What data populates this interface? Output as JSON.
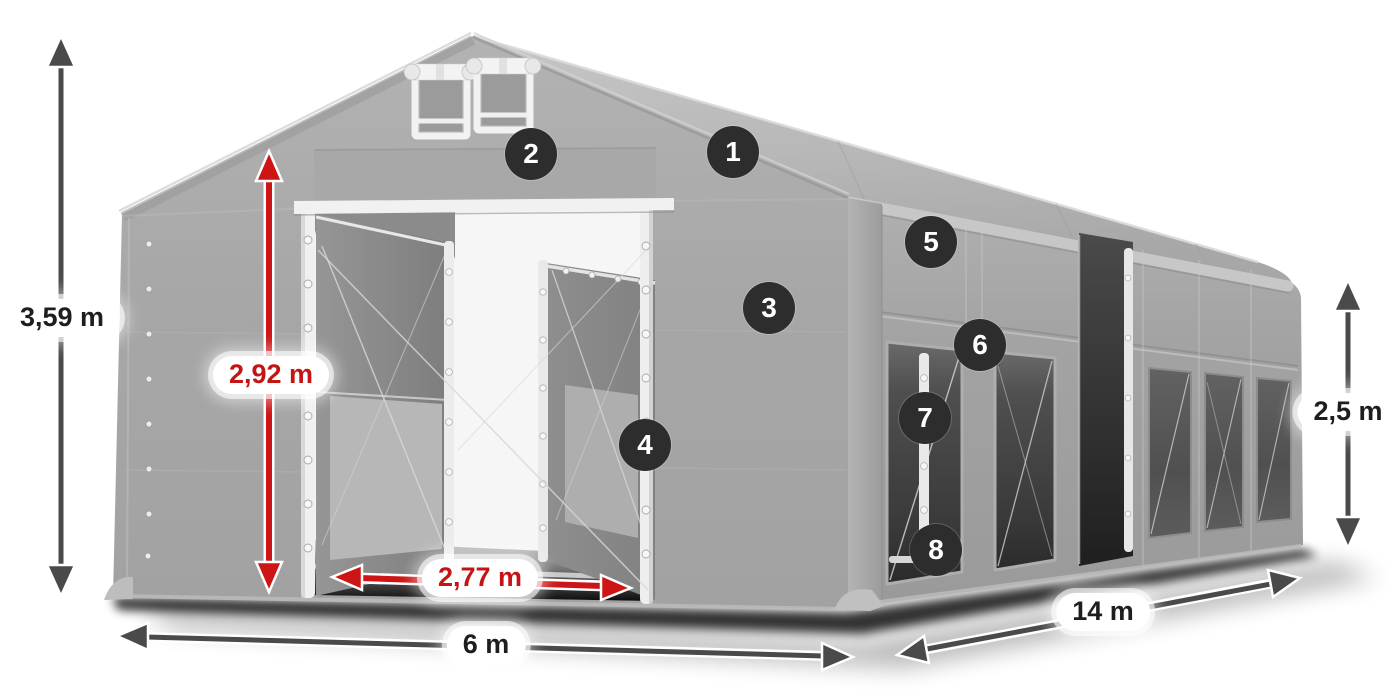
{
  "dims": {
    "total_height": {
      "label": "3,59 m",
      "style": "dark"
    },
    "entrance_height": {
      "label": "2,92 m",
      "style": "red"
    },
    "entrance_width": {
      "label": "2,77 m",
      "style": "red"
    },
    "front_width": {
      "label": "6 m",
      "style": "dark"
    },
    "side_length": {
      "label": "14 m",
      "style": "dark"
    },
    "side_height": {
      "label": "2,5 m",
      "style": "dark"
    }
  },
  "callouts": [
    "1",
    "2",
    "3",
    "4",
    "5",
    "6",
    "7",
    "8"
  ],
  "colors": {
    "dimension_red": "#ce1515",
    "dimension_dark": "#4a4a4a",
    "badge_background": "#2d2d2d",
    "badge_text": "#ffffff",
    "label_background": "#ffffff",
    "label_text": "#1e1e1e",
    "tent_gray": "#a6a6a6"
  }
}
